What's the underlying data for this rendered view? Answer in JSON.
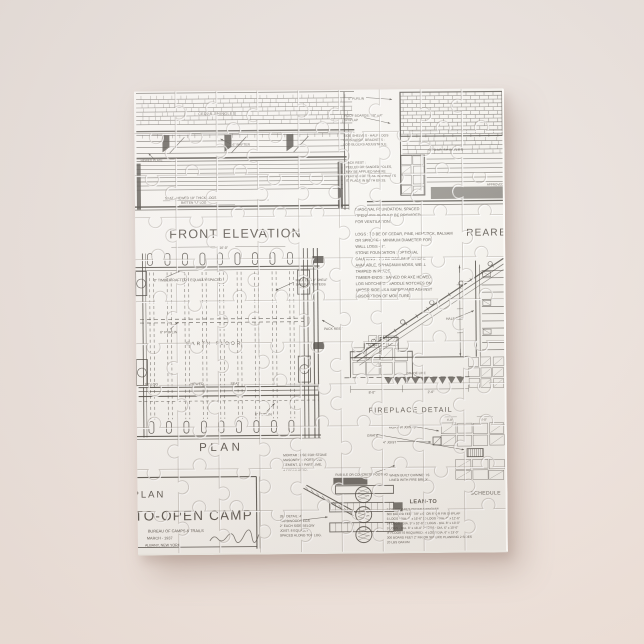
{
  "colors": {
    "background": "#ece4de",
    "puzzle_surface": "#f9f8f4",
    "ink": "#3a362f",
    "shadow": "rgba(146,120,108,0.38)"
  },
  "drawing": {
    "front_elevation": {
      "title": "FRONT ELEVATION",
      "dim": "16'-0\"",
      "cedar_shingles": "CEDAR SHINGLES",
      "rafter": "6\" RAFTER",
      "plate": "HEWED PLATE",
      "seat_note": [
        "SEAT - HEWED 10\" THICK LOGS",
        "BATTEN \"U\" LOG"
      ]
    },
    "roof_notes": {
      "purlin": "4\" PURLIN",
      "roof_boards": [
        "ROOF BOARDS: 7/8\" x 8\"",
        "SHIPLAP"
      ],
      "shelves": [
        "SIDE SHELVES - HALF LOGS",
        "OR BOARDS, BRACKETS -",
        "LOG BLOCKS ADJUSTABLE."
      ],
      "pack_rest": [
        "PACK REST :",
        "PEELED OR SANDED POLES,",
        "MAY BE APPLIED WHERE",
        "PORTION OF TRAIL WARRANTS",
        "IT, PLACE IN BOTH ENDS."
      ]
    },
    "rear_elevation": {
      "cedar_shingles": "CEDAR SHINGLES",
      "title": "REAR",
      "title_cut": "ELEVATION",
      "approved": "APPROVED"
    },
    "general_notes": [
      "DIAGONAL FOUNDATION, SPACED",
      "OPENINGS SHOULD BE PROVIDED",
      "FOR VENTILATION.",
      " ",
      "LOGS : TO BE OF CEDAR, PINE, HEMLOCK, BALSAM",
      "OR SPRUCE, - MINIMUM DIAMETER FOR",
      "WALL LOGS - 8\".",
      "STONE FOUNDATION : OPTIONAL",
      "CAULKING : TO BE OAKUM IF WHERE",
      "AVAILABLE, SPHAGNUM MOSS, WELL",
      "TAMPED IN PLACE.",
      "TIMBER-ENDS : SAWED OR AXE HEWED.",
      "LOG NOTCHING : SADDLE NOTCHES ON",
      "UNDER SIDE AS A SAFEGUARD AGAINST",
      "ABSORPTION OF MOISTURE."
    ],
    "plan": {
      "rafters_note": "8\" TIMBER RAFTERS EQUALLY SPACED",
      "shelf_note": [
        "HALF LOG 8\" SHELF",
        "SHELF WITH PEGS"
      ],
      "purlin_a": "6\" PURLIN",
      "earth_floor": "EARTH FLOOR",
      "log_label": "10\" LOG",
      "hewed_label": "HEWED",
      "seat_label": "SEAT",
      "purlin_b": "6\" PURLIN",
      "pack_rest": "PACK REST",
      "title": "PLAN"
    },
    "section": {
      "half_log": "HALF LOG"
    },
    "fireplace": {
      "grade_line": "GRADE LINE",
      "dim_left": "8'-0\"",
      "dim_right": "2'-6\"",
      "title": "FIREPLACE DETAIL",
      "mortar_joints": "MORTAR JOINTS",
      "grate": "GRATE",
      "joist": "4\" JOIST",
      "dim_a": "4'-0\"",
      "dim_b": "4'-0\"",
      "firebrick_note": [
        "WHEN BUILT CHIMNEY IS",
        "LINED WITH FIRE BRICK."
      ]
    },
    "masonry_notes": {
      "mortar": [
        "MORTAR : USE FOR STONE",
        "MASONRY 1: PORTLAND",
        "CEMENT, 1/2 PART LIME,",
        "3 PARTS SAND."
      ],
      "rubble": "RUBBLE OR CONCRETE FOOTING"
    },
    "peg_notes": [
      "28 - DETAIL: 4\"",
      "HARDWOOD PEGS",
      "2\" EACH SIDE BELOW",
      "JOIST. 8 EQUALLY",
      "SPACED ALONG TOP LOG."
    ],
    "title_block": {
      "plan_label": "PLAN",
      "camp_title": "LEAN-TO-OPEN CAMP",
      "bureau": "BUREAU OF CAMPS & TRAILS",
      "date": "MARCH - 1937",
      "place": "ALBANY, NEW YORK"
    },
    "schedule": {
      "header": "LEAN-TO",
      "label": "SCHEDULE",
      "lines": [
        "2 OR SQUARES CEDAR SHINGLES",
        "600 BOARD FEET 7/8\" x 6\" OR 8\" OR FIR SHIPLAP",
        "6 LOGS - DIA. 9\" x 16'-6\"  10 LOGS - DIA. 7\" x 12'-6\"",
        "14 LOGS - DIA. 9\" x 10'-6\"  2 LOGS - DIA. 8\" x 13'-0\"",
        "3 LOGS - DIA. 6\" x 16'-0\"  7 LOGS - DIA. 6\" x 10'-0\"",
        "IF FLOOR IS REQUIRED : 4 LOGS DIA. 6\" x 13'-0\"",
        "300 BOARD FEET 2\" FIR OR SPRUCE PLANKING 2 SIDES",
        "20 LBS OAKUM"
      ]
    }
  }
}
